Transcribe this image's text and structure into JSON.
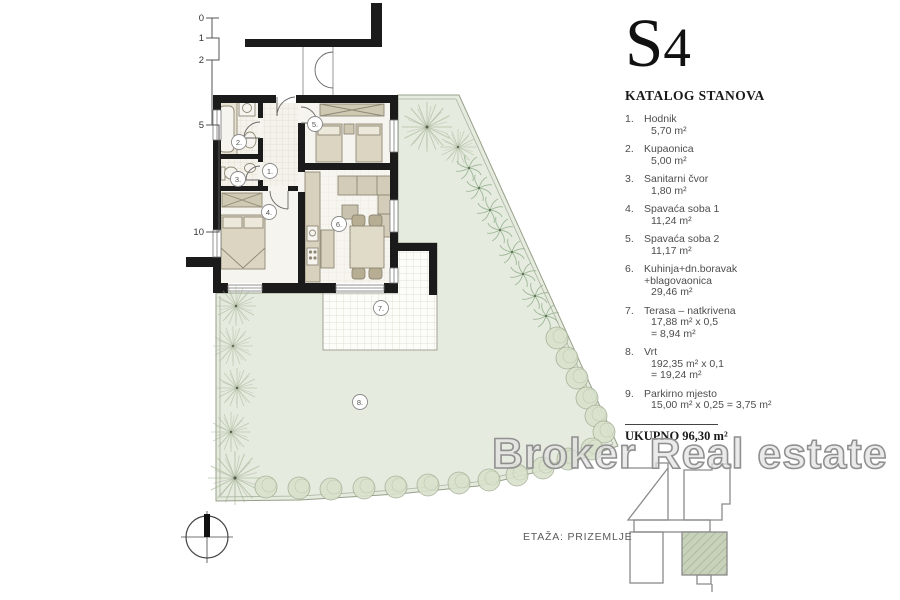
{
  "title": "S4",
  "catalog": {
    "heading": "KATALOG STANOVA"
  },
  "rooms": [
    {
      "num": "1.",
      "name": [
        "Hodnik"
      ],
      "values": [
        "5,70 m²"
      ]
    },
    {
      "num": "2.",
      "name": [
        "Kupaonica"
      ],
      "values": [
        "5,00 m²"
      ]
    },
    {
      "num": "3.",
      "name": [
        "Sanitarni čvor"
      ],
      "values": [
        "1,80 m²"
      ]
    },
    {
      "num": "4.",
      "name": [
        "Spavaća soba 1"
      ],
      "values": [
        "11,24 m²"
      ]
    },
    {
      "num": "5.",
      "name": [
        "Spavaća soba 2"
      ],
      "values": [
        "11,17 m²"
      ]
    },
    {
      "num": "6.",
      "name": [
        "Kuhinja+dn.boravak",
        "+blagovaonica"
      ],
      "values": [
        "29,46 m²"
      ]
    },
    {
      "num": "7.",
      "name": [
        "Terasa – natkrivena"
      ],
      "values": [
        "17,88 m² x 0,5",
        "= 8,94 m²"
      ]
    },
    {
      "num": "8.",
      "name": [
        "Vrt"
      ],
      "values": [
        "192,35 m² x 0,1",
        "= 19,24 m²"
      ]
    },
    {
      "num": "9.",
      "name": [
        "Parkirno mjesto"
      ],
      "values": [
        "15,00 m² x 0,25 = 3,75 m²"
      ]
    }
  ],
  "total": {
    "label": "UKUPNO",
    "value": "96,30 m²"
  },
  "floor_label": "ETAŽA: PRIZEMLJE",
  "watermark": "Broker Real estate",
  "scale": {
    "ticks": [
      "0",
      "1",
      "2",
      "5",
      "10"
    ]
  },
  "plan": {
    "room_labels": [
      "1.",
      "2.",
      "3.",
      "4.",
      "5.",
      "6.",
      "7.",
      "8."
    ]
  },
  "colors": {
    "wall": "#1b1b1b",
    "garden": "#e6ebdf",
    "furniture": "#d8d1bd",
    "tree": "#9cb28c",
    "highlighted_unit": "#c5cfb8"
  }
}
